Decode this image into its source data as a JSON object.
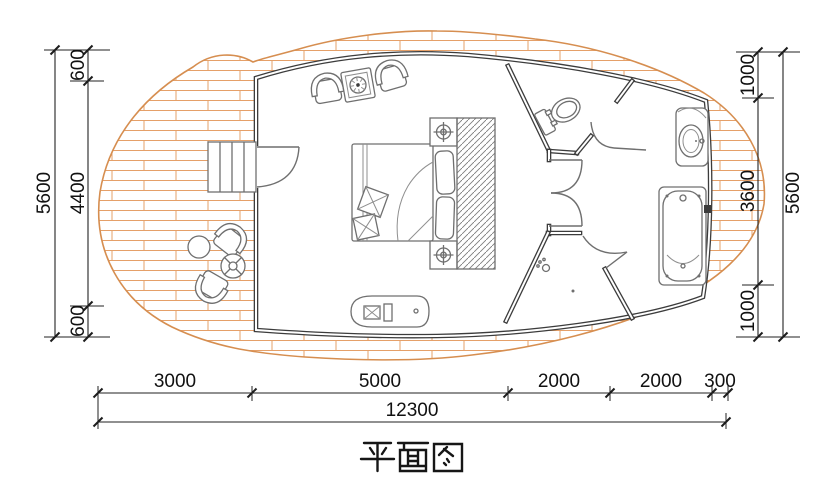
{
  "title": {
    "text": "平面图"
  },
  "dimensions": {
    "left": {
      "total": "5600",
      "segments": [
        "600",
        "4400",
        "600"
      ]
    },
    "right": {
      "total": "5600",
      "segments": [
        "1000",
        "3600",
        "1000"
      ]
    },
    "bottom": {
      "total": "12300",
      "segments": [
        "3000",
        "5000",
        "2000",
        "2000",
        "300"
      ]
    }
  },
  "colors": {
    "wall": "#3c3c3c",
    "furniture_line": "#6f6f6f",
    "deck_plank": "#e5a069",
    "deck_edge": "#d68e50",
    "dimension": "#1d1d1d",
    "background": "#ffffff"
  },
  "fixtures": [
    "wood-deck",
    "entrance-stairs",
    "entrance-door",
    "bed",
    "head-pillows",
    "decor-pillows",
    "wardrobe",
    "nightstand",
    "ceiling-lamp",
    "armchair",
    "stove-table",
    "media-console",
    "toilet",
    "double-door",
    "shower-room",
    "shower-drain",
    "bathtub",
    "vanity-sink",
    "outdoor-chair",
    "outdoor-side-table",
    "outdoor-parasol-table"
  ]
}
